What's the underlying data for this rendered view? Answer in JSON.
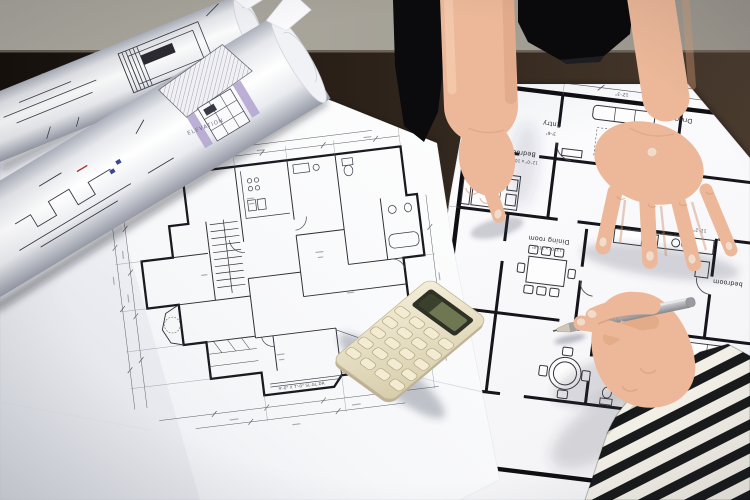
{
  "scene": {
    "colors": {
      "wall": "#a9a69c",
      "table_dark": "#1d150f",
      "table_warm": "#46382c",
      "paper": "#fafafc",
      "plan_ink": "#2a2a33",
      "thick_wall_ink": "#121217",
      "elevation_purple": "#b2a2cf",
      "skin": "#ecb899",
      "clothing_black": "#0a0a0c",
      "sleeve_stripe_dark": "#191a1c",
      "sleeve_stripe_light": "#f2efe7",
      "calculator_body": "#ece4cb",
      "calculator_lcd": "#6e7652",
      "pencil_grey": "#b9babe"
    }
  },
  "rolled_plans": {
    "elevation_label": "ELEVATION"
  },
  "center_plan": {
    "patio_note": "9'-0\" X 7'-0\" SL.GL.DR."
  },
  "right_plan": {
    "labels": {
      "entry": "Entry",
      "drawing": "Drwg room",
      "bedroom_left": "Bedroom",
      "dining": "Dining room",
      "bedroom_right": "bedroom"
    },
    "sizes": {
      "dining": "13'-0\" x 11'-0\"",
      "bedroom": "12'-0\" x 10'-6\""
    },
    "dims": {
      "entry": "3'-6\"",
      "left": "17'-9\"",
      "top": "12'-3\"",
      "margin": "10'-7\"",
      "kitchen": "11'-2\""
    }
  }
}
